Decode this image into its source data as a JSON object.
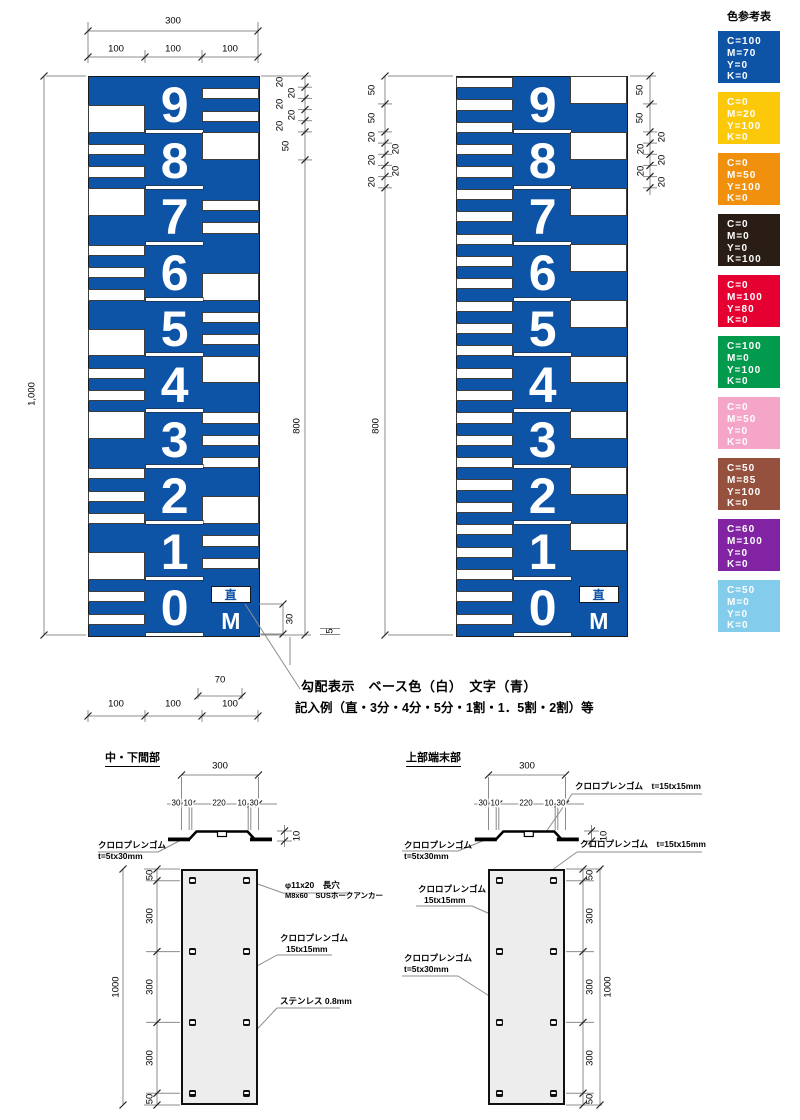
{
  "labels": {
    "grade": "直",
    "meter": "M"
  },
  "gauge1_sections": [
    {
      "digit": "9",
      "stripe_side": "R",
      "stripe_offsets": [
        20,
        60
      ],
      "block_side": "L",
      "block_pos": "bottom"
    },
    {
      "digit": "8",
      "stripe_side": "L",
      "stripe_offsets": [
        20,
        60
      ],
      "block_side": "R",
      "block_pos": "top"
    },
    {
      "digit": "7",
      "stripe_side": "R",
      "stripe_offsets": [
        20,
        60
      ],
      "block_side": "L",
      "block_pos": "top"
    },
    {
      "digit": "6",
      "stripe_side": "L",
      "stripe_offsets": [
        0,
        40,
        80
      ],
      "block_side": "R",
      "block_pos": "bottom"
    },
    {
      "digit": "5",
      "stripe_side": "R",
      "stripe_offsets": [
        20,
        60
      ],
      "block_side": "L",
      "block_pos": "bottom"
    },
    {
      "digit": "4",
      "stripe_side": "L",
      "stripe_offsets": [
        20,
        60
      ],
      "block_side": "R",
      "block_pos": "top"
    },
    {
      "digit": "3",
      "stripe_side": "R",
      "stripe_offsets": [
        0,
        40,
        80
      ],
      "block_side": "L",
      "block_pos": "top"
    },
    {
      "digit": "2",
      "stripe_side": "L",
      "stripe_offsets": [
        0,
        40,
        80
      ],
      "block_side": "R",
      "block_pos": "bottom"
    },
    {
      "digit": "1",
      "stripe_side": "R",
      "stripe_offsets": [
        20,
        60
      ],
      "block_side": "L",
      "block_pos": "bottom"
    },
    {
      "digit": "0",
      "stripe_side": "L",
      "stripe_offsets": [
        20,
        60
      ],
      "block_side": null,
      "special": "grade-box"
    }
  ],
  "gauge2_sections": [
    {
      "digit": "9",
      "stripe_side": "L",
      "stripe_offsets": [
        0,
        40,
        80
      ],
      "block_side": "R",
      "block_pos": "top"
    },
    {
      "digit": "8",
      "stripe_side": "L",
      "stripe_offsets": [
        20,
        60
      ],
      "block_side": "R",
      "block_pos": "top"
    },
    {
      "digit": "7",
      "stripe_side": "L",
      "stripe_offsets": [
        0,
        40,
        80
      ],
      "block_side": "R",
      "block_pos": "top"
    },
    {
      "digit": "6",
      "stripe_side": "L",
      "stripe_offsets": [
        20,
        60
      ],
      "block_side": "R",
      "block_pos": "top"
    },
    {
      "digit": "5",
      "stripe_side": "L",
      "stripe_offsets": [
        0,
        40,
        80
      ],
      "block_side": "R",
      "block_pos": "top"
    },
    {
      "digit": "4",
      "stripe_side": "L",
      "stripe_offsets": [
        20,
        60
      ],
      "block_side": "R",
      "block_pos": "top"
    },
    {
      "digit": "3",
      "stripe_side": "L",
      "stripe_offsets": [
        0,
        40,
        80
      ],
      "block_side": "R",
      "block_pos": "top"
    },
    {
      "digit": "2",
      "stripe_side": "L",
      "stripe_offsets": [
        20,
        60
      ],
      "block_side": "R",
      "block_pos": "top"
    },
    {
      "digit": "1",
      "stripe_side": "L",
      "stripe_offsets": [
        0,
        40,
        80
      ],
      "block_side": "R",
      "block_pos": "top"
    },
    {
      "digit": "0",
      "stripe_side": "L",
      "stripe_offsets": [
        20,
        60
      ],
      "block_side": null,
      "special": "grade-box"
    }
  ],
  "colors": {
    "gauge_blue": "#0d53a6",
    "line_gray": "#8c8c8c",
    "ink": "#000000"
  },
  "notes": {
    "line1": "勾配表示　ベース色（白）　文字（青）",
    "line2": "記入例（直・3分・4分・5分・1割・1．5割・2割）等"
  },
  "color_table": {
    "title": "色参考表",
    "swatches": [
      {
        "color": "#0d53a6",
        "lines": [
          "C=100",
          "M=70",
          "Y=0",
          "K=0"
        ]
      },
      {
        "color": "#fcc80a",
        "lines": [
          "C=0",
          "M=20",
          "Y=100",
          "K=0"
        ]
      },
      {
        "color": "#f0900c",
        "lines": [
          "C=0",
          "M=50",
          "Y=100",
          "K=0"
        ]
      },
      {
        "color": "#291d15",
        "lines": [
          "C=0",
          "M=0",
          "Y=0",
          "K=100"
        ]
      },
      {
        "color": "#e60032",
        "lines": [
          "C=0",
          "M=100",
          "Y=80",
          "K=0"
        ]
      },
      {
        "color": "#029a4c",
        "lines": [
          "C=100",
          "M=0",
          "Y=100",
          "K=0"
        ]
      },
      {
        "color": "#f5a6c8",
        "lines": [
          "C=0",
          "M=50",
          "Y=0",
          "K=0"
        ]
      },
      {
        "color": "#96503e",
        "lines": [
          "C=50",
          "M=85",
          "Y=100",
          "K=0"
        ]
      },
      {
        "color": "#8123a2",
        "lines": [
          "C=60",
          "M=100",
          "Y=0",
          "K=0"
        ]
      },
      {
        "color": "#84ccec",
        "lines": [
          "C=50",
          "M=0",
          "Y=0",
          "K=0"
        ]
      }
    ]
  },
  "drawing_left_title": "中・下間部",
  "drawing_right_title": "上部端末部",
  "callouts": {
    "rubber": "クロロプレンゴム",
    "rubber_t5": "t=5tx30mm",
    "rubber_15": "15tx15mm",
    "rubber_t15": "クロロプレンゴム　t=15tx15mm",
    "anchor1": "φ11x20　長穴",
    "anchor2": "M8x60　SUSホークアンカー",
    "sus": "ステンレス 0.8mm"
  },
  "dim_labels": [
    {
      "t": "300",
      "x": 173,
      "y": 21
    },
    {
      "t": "100",
      "x": 116,
      "y": 49
    },
    {
      "t": "100",
      "x": 173,
      "y": 49
    },
    {
      "t": "100",
      "x": 230,
      "y": 49
    },
    {
      "t": "1,000",
      "x": 32,
      "y": 394,
      "r": 1
    },
    {
      "t": "20",
      "x": 280,
      "y": 82,
      "r": 1
    },
    {
      "t": "20",
      "x": 292,
      "y": 93,
      "r": 1
    },
    {
      "t": "20",
      "x": 280,
      "y": 104,
      "r": 1
    },
    {
      "t": "20",
      "x": 292,
      "y": 115,
      "r": 1
    },
    {
      "t": "20",
      "x": 280,
      "y": 126,
      "r": 1
    },
    {
      "t": "50",
      "x": 286,
      "y": 146,
      "r": 1
    },
    {
      "t": "800",
      "x": 297,
      "y": 426,
      "r": 1
    },
    {
      "t": "30",
      "x": 290,
      "y": 619,
      "r": 1
    },
    {
      "t": "5",
      "x": 330,
      "y": 631,
      "r": 1
    },
    {
      "t": "70",
      "x": 220,
      "y": 680
    },
    {
      "t": "100",
      "x": 116,
      "y": 704
    },
    {
      "t": "100",
      "x": 173,
      "y": 704
    },
    {
      "t": "100",
      "x": 230,
      "y": 704
    },
    {
      "t": "50",
      "x": 372,
      "y": 90,
      "r": 1
    },
    {
      "t": "50",
      "x": 372,
      "y": 118,
      "r": 1
    },
    {
      "t": "20",
      "x": 372,
      "y": 137,
      "r": 1
    },
    {
      "t": "20",
      "x": 396,
      "y": 149,
      "r": 1
    },
    {
      "t": "20",
      "x": 372,
      "y": 160,
      "r": 1
    },
    {
      "t": "20",
      "x": 396,
      "y": 171,
      "r": 1
    },
    {
      "t": "20",
      "x": 372,
      "y": 182,
      "r": 1
    },
    {
      "t": "800",
      "x": 376,
      "y": 426,
      "r": 1
    },
    {
      "t": "50",
      "x": 640,
      "y": 90,
      "r": 1
    },
    {
      "t": "50",
      "x": 640,
      "y": 118,
      "r": 1
    },
    {
      "t": "20",
      "x": 662,
      "y": 137,
      "r": 1
    },
    {
      "t": "20",
      "x": 641,
      "y": 149,
      "r": 1
    },
    {
      "t": "20",
      "x": 662,
      "y": 160,
      "r": 1
    },
    {
      "t": "20",
      "x": 641,
      "y": 171,
      "r": 1
    },
    {
      "t": "20",
      "x": 662,
      "y": 182,
      "r": 1
    },
    {
      "t": "300",
      "x": 220,
      "y": 766
    },
    {
      "t": "30",
      "x": 176,
      "y": 803,
      "bg": 1
    },
    {
      "t": "10",
      "x": 188,
      "y": 803,
      "bg": 1
    },
    {
      "t": "220",
      "x": 219,
      "y": 803,
      "bg": 1
    },
    {
      "t": "10",
      "x": 242,
      "y": 803,
      "bg": 1
    },
    {
      "t": "30",
      "x": 254,
      "y": 803,
      "bg": 1
    },
    {
      "t": "10",
      "x": 297,
      "y": 836,
      "r": 1
    },
    {
      "t": "50",
      "x": 150,
      "y": 875,
      "r": 1
    },
    {
      "t": "300",
      "x": 150,
      "y": 916,
      "r": 1
    },
    {
      "t": "300",
      "x": 150,
      "y": 987,
      "r": 1
    },
    {
      "t": "300",
      "x": 150,
      "y": 1058,
      "r": 1
    },
    {
      "t": "50",
      "x": 150,
      "y": 1099,
      "r": 1
    },
    {
      "t": "1000",
      "x": 116,
      "y": 987,
      "r": 1
    },
    {
      "t": "300",
      "x": 527,
      "y": 766
    },
    {
      "t": "30",
      "x": 483,
      "y": 803,
      "bg": 1
    },
    {
      "t": "10",
      "x": 495,
      "y": 803,
      "bg": 1
    },
    {
      "t": "220",
      "x": 526,
      "y": 803,
      "bg": 1
    },
    {
      "t": "10",
      "x": 549,
      "y": 803,
      "bg": 1
    },
    {
      "t": "30",
      "x": 561,
      "y": 803,
      "bg": 1
    },
    {
      "t": "10",
      "x": 604,
      "y": 836,
      "r": 1
    },
    {
      "t": "50",
      "x": 590,
      "y": 875,
      "r": 1
    },
    {
      "t": "300",
      "x": 590,
      "y": 916,
      "r": 1
    },
    {
      "t": "300",
      "x": 590,
      "y": 987,
      "r": 1
    },
    {
      "t": "300",
      "x": 590,
      "y": 1058,
      "r": 1
    },
    {
      "t": "50",
      "x": 590,
      "y": 1099,
      "r": 1
    },
    {
      "t": "1000",
      "x": 608,
      "y": 987,
      "r": 1
    }
  ]
}
